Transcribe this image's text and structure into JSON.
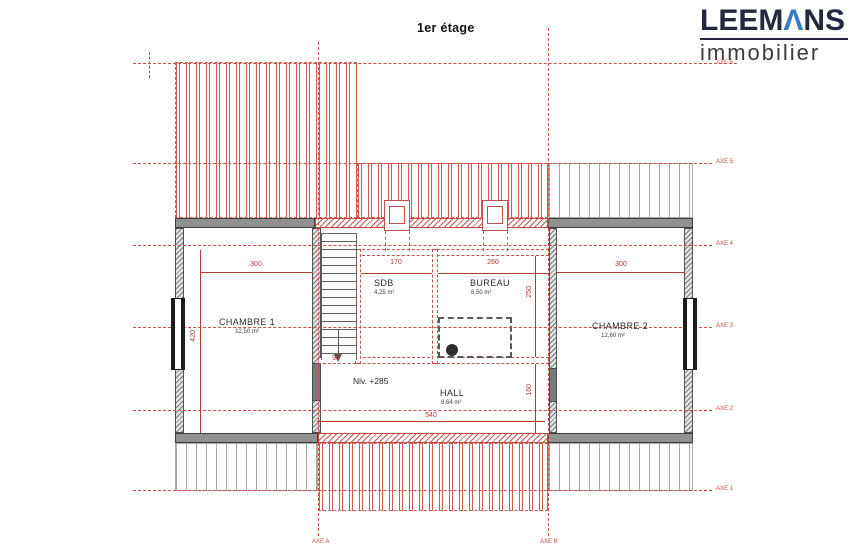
{
  "title": "1er étage",
  "logo": {
    "brand_full": "LEEMANS",
    "brand_pre": "LEEM",
    "brand_accent": "Λ",
    "brand_post": "NS",
    "subtitle": "immobilier"
  },
  "plan": {
    "level_note": "Niv. +285",
    "rooms": [
      {
        "name": "CHAMBRE 1",
        "area": "12,50 m²"
      },
      {
        "name": "SDB",
        "area": "4,25 m²"
      },
      {
        "name": "BUREAU",
        "area": "6,50 m²"
      },
      {
        "name": "CHAMBRE 2",
        "area": "12,60 m²"
      },
      {
        "name": "HALL",
        "area": "8,64 m²"
      }
    ],
    "dimensions": {
      "chambre1_width": "300",
      "sdb_width": "170",
      "bureau_width": "260",
      "chambre2_width": "300",
      "chambre1_depth": "420",
      "stair_width": "90",
      "bureau_depth": "250",
      "hall_depth": "160",
      "hall_width": "540"
    },
    "axes": {
      "h": [
        "AXE 6",
        "AXE 5",
        "AXE 4",
        "AXE 3",
        "AXE 2",
        "AXE 1"
      ],
      "v": [
        "AXE A",
        "AXE B"
      ]
    }
  },
  "colors": {
    "dimension_red": "#b23b34",
    "axis_red": "#cb4f47",
    "wall_gray": "#919191",
    "logo_navy": "#23283d",
    "logo_blue": "#3a7cc1"
  }
}
